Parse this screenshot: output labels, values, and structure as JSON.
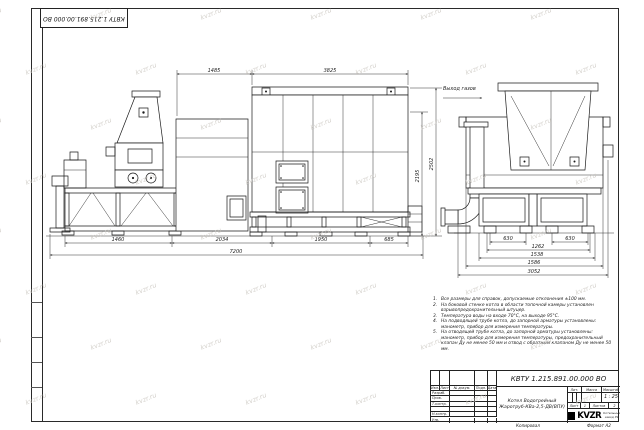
{
  "sheet": {
    "corner_designation": "КВТУ 1.215.891.00.000 ВО",
    "copied_label": "Копировал",
    "format_label": "Формат А2"
  },
  "watermark": {
    "text": "kvzr.ru"
  },
  "drawing": {
    "gas_outlet_label": "Выход газов",
    "main_view": {
      "dim_top_left": "1485",
      "dim_top_right": "3825",
      "dims_bottom": [
        "1460",
        "2034",
        "1950",
        "685"
      ],
      "dim_total": "7200",
      "dim_height_inner": "2195",
      "dim_height_outer": "2502"
    },
    "end_view": {
      "dims": [
        "630",
        "630",
        "1262",
        "1538",
        "1586",
        "3052"
      ]
    }
  },
  "notes": {
    "items": [
      {
        "num": "1.",
        "text": "Все размеры для справок, допускаемые отклонения ±100 мм."
      },
      {
        "num": "2.",
        "text": "На боковой стенке котла в области топочной камеры установлен взрывопредохранительный штуцер."
      },
      {
        "num": "3.",
        "text": "Температура воды на входе 70°С, на выходе 95°С."
      },
      {
        "num": "4.",
        "text": "На подводящей трубе котла, до запорной арматуры установлены: манометр, прибор для измерения температуры."
      },
      {
        "num": "5.",
        "text": "На отводящей трубе котла, до запорной арматуры установлены: манометр, прибор для измерения температуры, предохранительный клапан Ду не менее 50 мм и отвод с обратным клапаном Ду не менее 50 мм."
      }
    ]
  },
  "title_block": {
    "designation": "КВТУ 1.215.891.00.000 ВО",
    "name_line1": "Котел Водогрейный",
    "name_line2": "Жаротруб-КВа-2,5-ДВ(ВПУ)",
    "col_izm": "Изм.",
    "col_list": "Лист",
    "col_doc": "№ докум.",
    "col_sign": "Подп.",
    "col_date": "Дата",
    "rows": [
      "Разраб.",
      "Пров.",
      "Т.контр.",
      "",
      "Н.контр.",
      "Утв."
    ],
    "lit_label": "Лит.",
    "mass_label": "Масса",
    "scale_label": "Масштаб",
    "scale_value": "1 : 25",
    "sheet_label": "Лист",
    "sheet_value": "1",
    "sheets_label": "Листов",
    "sheets_value": "2",
    "logo_text": "KVZR",
    "company_line1": "Котельный",
    "company_line2": "завод РФ"
  }
}
